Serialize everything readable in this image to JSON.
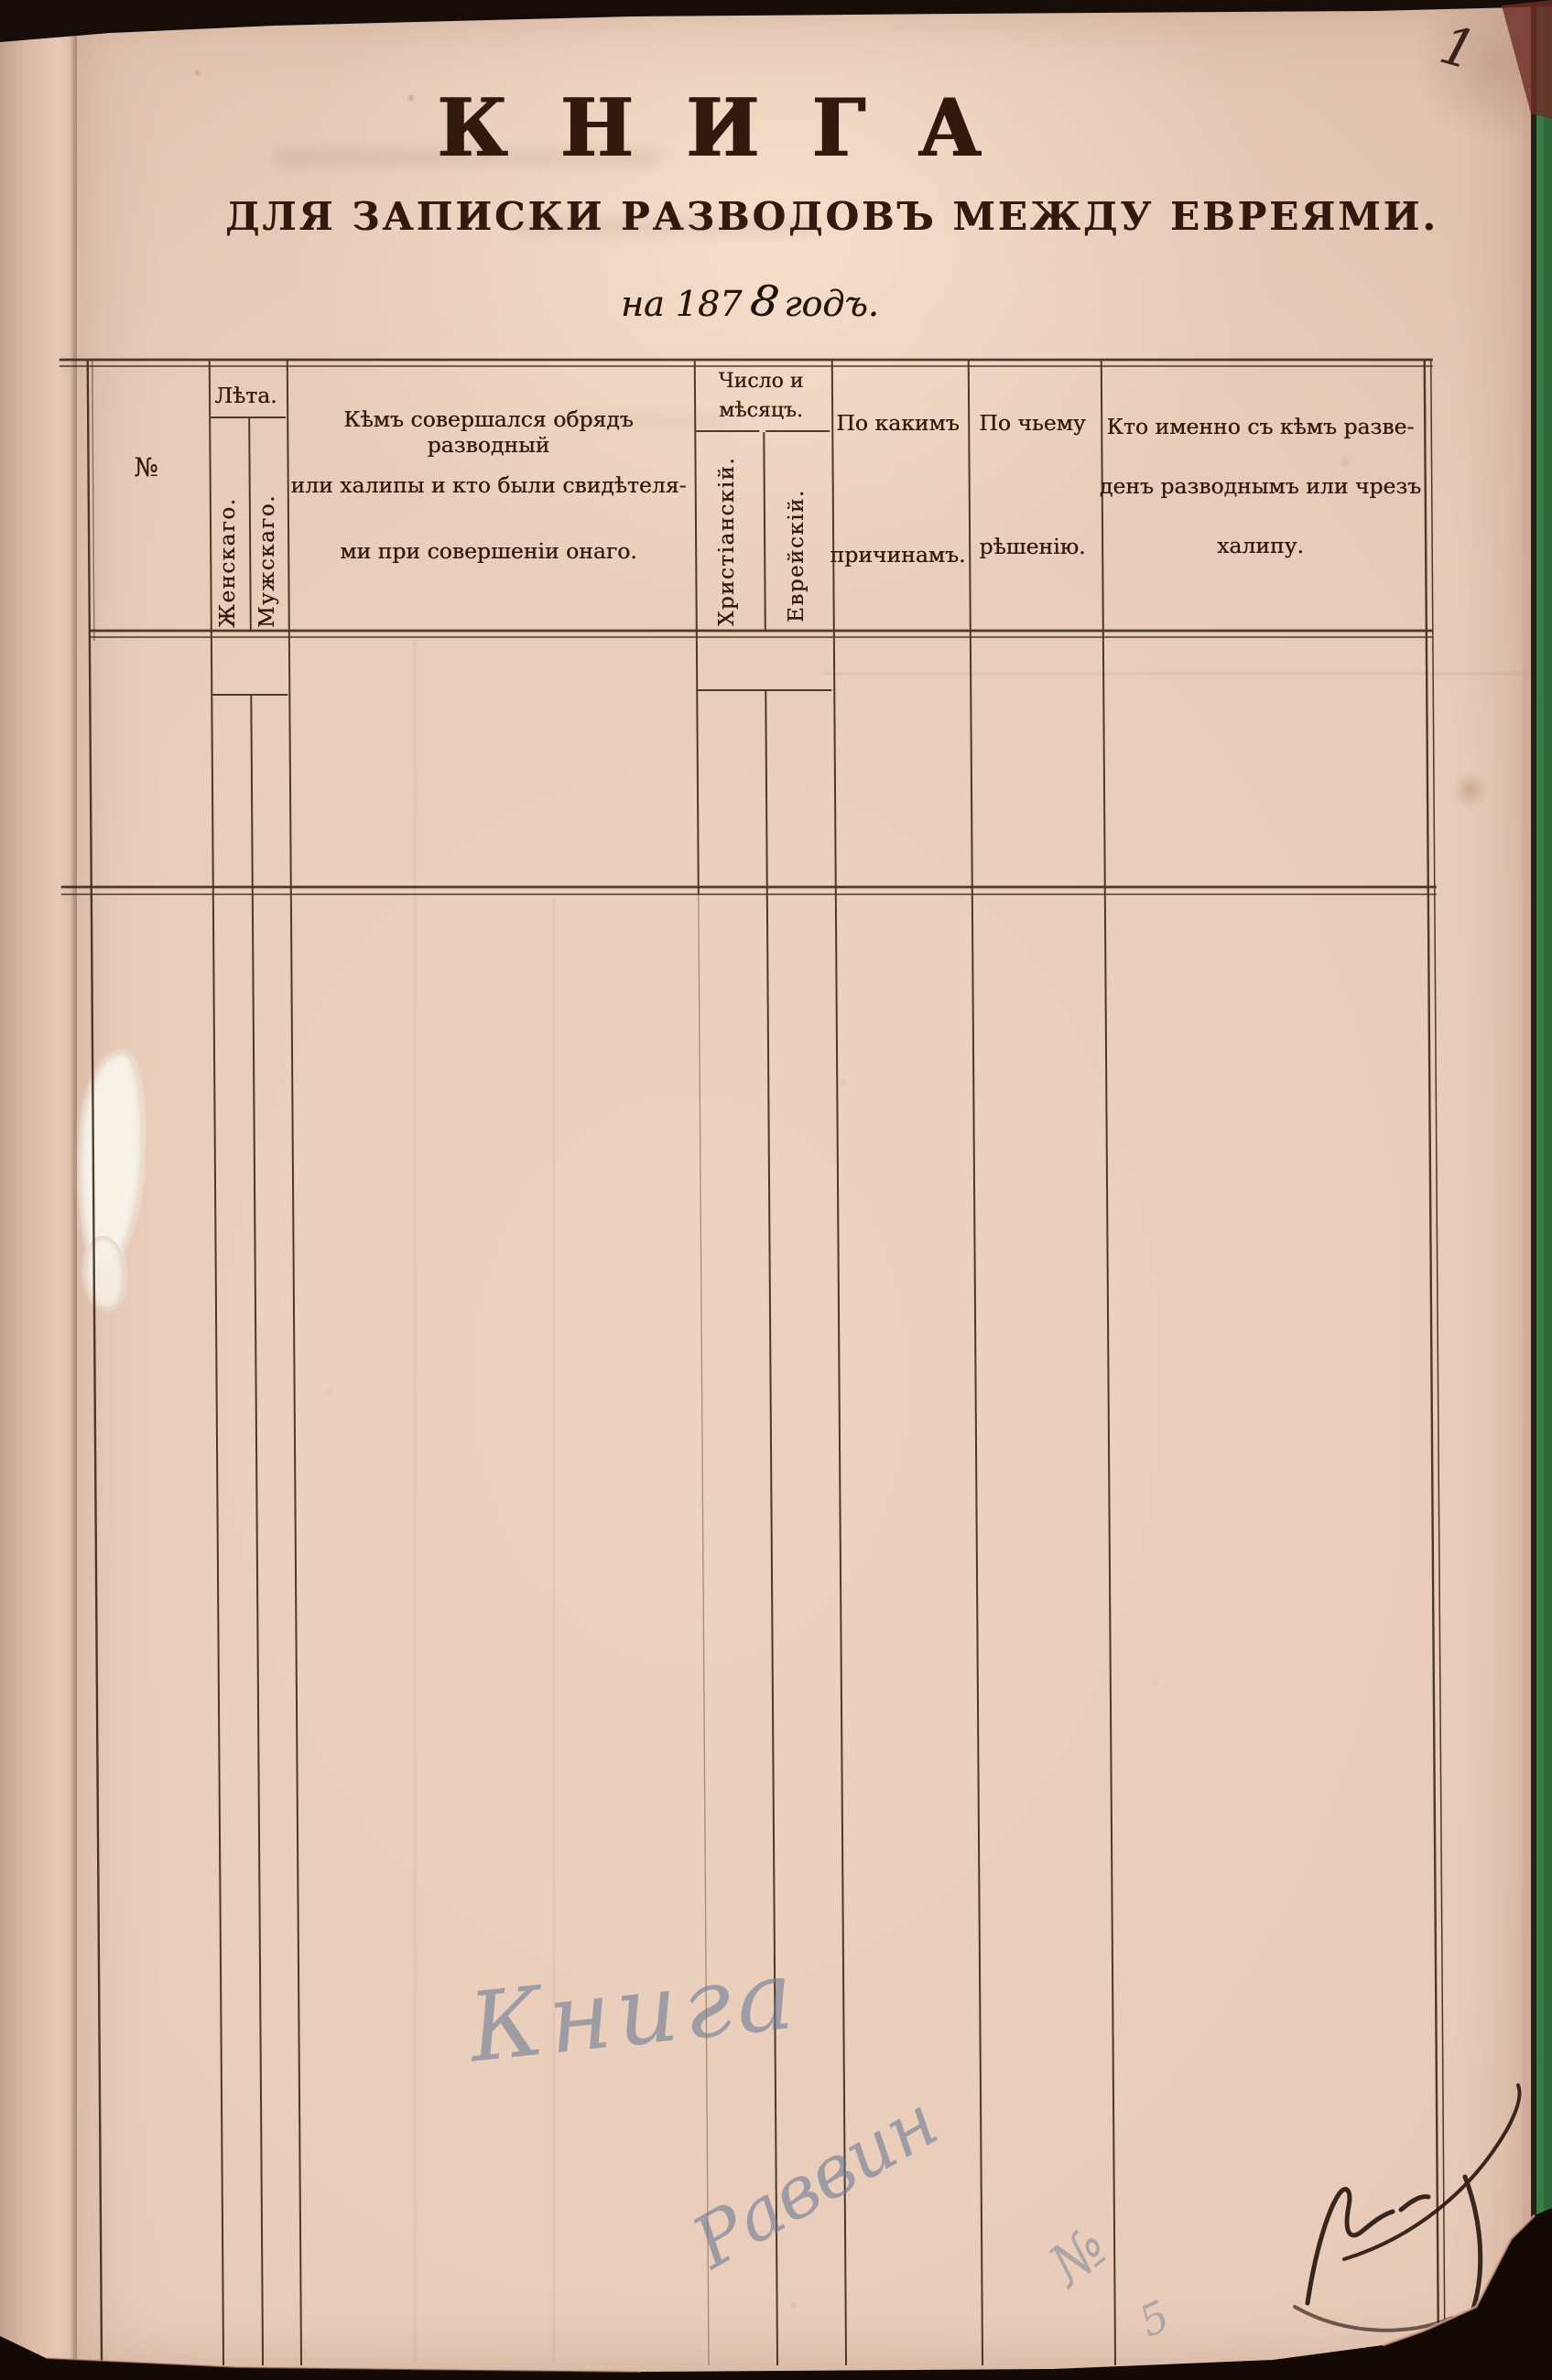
{
  "document": {
    "page_number": "1",
    "title": "КНИГА",
    "subtitle": "ДЛЯ ЗАПИСКИ РАЗВОДОВЪ МЕЖДУ ЕВРЕЯМИ.",
    "year_line": {
      "prefix": "на 187",
      "handwritten_digit": "8",
      "suffix": "годъ."
    }
  },
  "table": {
    "columns": [
      {
        "label": "№"
      },
      {
        "label": "Лѣта.",
        "subcolumns": [
          "Женскаго.",
          "Мужскаго."
        ]
      },
      {
        "label_lines": [
          "Кѣмъ совершался обрядъ разводный",
          "или халипы и кто были свидѣтеля-",
          "ми при совершеніи онаго."
        ]
      },
      {
        "label_lines": [
          "Число и",
          "мѣсяцъ."
        ],
        "subcolumns": [
          "Христіанскій.",
          "Еврейскій."
        ]
      },
      {
        "label_lines": [
          "По какимъ",
          "причинамъ."
        ]
      },
      {
        "label_lines": [
          "По чьему",
          "рѣшенію."
        ]
      },
      {
        "label_lines": [
          "Кто именно съ кѣмъ разве-",
          "денъ разводнымъ или чрезъ",
          "халипу."
        ]
      }
    ],
    "rows": []
  },
  "handwriting": {
    "page_number": "1",
    "blue_pencil": [
      "Книга",
      "Раввин",
      "№",
      "5"
    ],
    "ink_signature": "нрзб."
  },
  "colors": {
    "paper": "#ecd1bf",
    "ink": "#31190e",
    "pencil_blue": "#6a798f",
    "backing_green": "#3a7a44"
  }
}
